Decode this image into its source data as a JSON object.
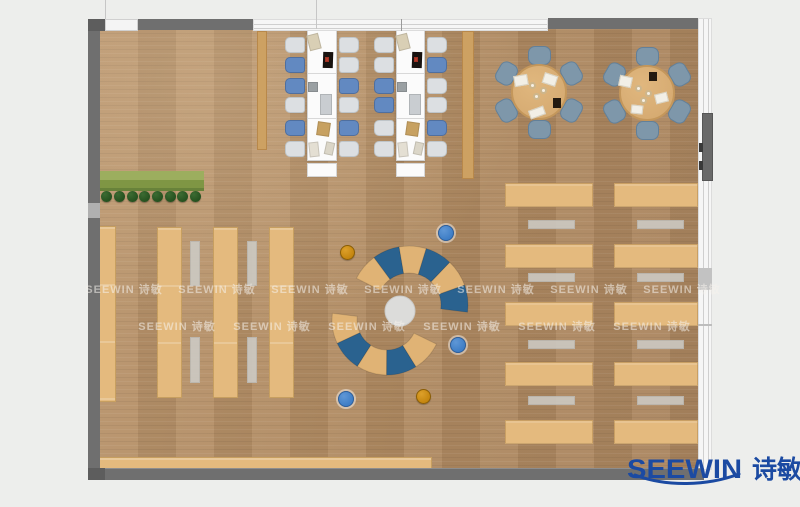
{
  "brand": {
    "logo_text": "SEEWIN",
    "logo_cn": "诗敏",
    "logo_color": "#1b4aa2"
  },
  "watermark": {
    "text": "SEEWIN 诗敏",
    "rows": [
      {
        "y": 281,
        "xs": [
          124,
          217,
          310,
          403,
          496,
          589,
          682
        ]
      },
      {
        "y": 318,
        "xs": [
          177,
          272,
          367,
          462,
          557,
          652
        ]
      }
    ]
  },
  "palette": {
    "bg": "#edeeec",
    "wood": "#b28e66",
    "wall": "#6f6f6f",
    "wall_dark": "#5d5d5d",
    "window": "#f6f6f6",
    "desk_white": "#fbfbfb",
    "chair_blue": "#6289c1",
    "chair_gray": "#dcdfe2",
    "table_tan": "#e4ba7e",
    "bench_gray": "#ccc9c2",
    "slate_chair": "#7e97aa",
    "sofa_blue": "#2a628f",
    "sofa_tan": "#e0b375",
    "lounge_circle": "#dcdcda",
    "green_bench": "#8ca050",
    "plant_green": "#25511f",
    "ottoman_blue": "#3f7ec6",
    "ottoman_orange": "#c5860f"
  },
  "furniture": {
    "green_bench": {
      "x": 100,
      "y": 171,
      "w": 104,
      "h": 20
    },
    "plants": {
      "y": 191,
      "size": 11,
      "xs": [
        106,
        119,
        132,
        144,
        157,
        170,
        182,
        195
      ]
    },
    "wood_strips": [
      {
        "x": 257,
        "y": 31,
        "w": 10,
        "h": 119
      },
      {
        "x": 462,
        "y": 31,
        "w": 12,
        "h": 148
      }
    ],
    "desk_clusters": [
      {
        "x": 307,
        "y": 30,
        "w": 30,
        "h": 131,
        "left_chairs": [
          "gray",
          "blue",
          "blue",
          "gray",
          "blue",
          "gray"
        ],
        "right_chairs": [
          "gray",
          "gray",
          "blue",
          "gray",
          "blue",
          "gray"
        ]
      },
      {
        "x": 396,
        "y": 30,
        "w": 29,
        "h": 131,
        "left_chairs": [
          "gray",
          "gray",
          "blue",
          "blue",
          "gray",
          "gray"
        ],
        "right_chairs": [
          "gray",
          "blue",
          "gray",
          "gray",
          "blue",
          "gray"
        ]
      }
    ],
    "desk_chair_rel_ys": [
      7,
      27,
      48,
      67,
      90,
      111
    ],
    "desk_props": [
      {
        "dx": 1,
        "dy": 4,
        "w": 12,
        "h": 16,
        "rot": -14,
        "c": "#d9cfb5"
      },
      {
        "dx": 16,
        "dy": 22,
        "w": 10,
        "h": 16,
        "rot": 2,
        "c": "#191310"
      },
      {
        "dx": 18,
        "dy": 27,
        "w": 4,
        "h": 5,
        "rot": 0,
        "c": "#b43a2a"
      },
      {
        "dx": 1,
        "dy": 52,
        "w": 10,
        "h": 10,
        "rot": 0,
        "c": "#9aa0a3"
      },
      {
        "dx": 13,
        "dy": 64,
        "w": 12,
        "h": 21,
        "rot": 0,
        "c": "#c9cdd1"
      },
      {
        "dx": 10,
        "dy": 92,
        "w": 13,
        "h": 14,
        "rot": 8,
        "c": "#c7a161"
      },
      {
        "dx": 2,
        "dy": 112,
        "w": 10,
        "h": 15,
        "rot": -6,
        "c": "#e4dfd3"
      },
      {
        "dx": 18,
        "dy": 112,
        "w": 9,
        "h": 13,
        "rot": 12,
        "c": "#dbd6c8"
      }
    ],
    "round_tables": [
      {
        "cx": 539,
        "cy": 92,
        "r": 28,
        "props": [
          {
            "dx": 4,
            "dy": -18,
            "w": 14,
            "h": 11,
            "rot": 18,
            "c": "paper"
          },
          {
            "dx": -25,
            "dy": -17,
            "w": 14,
            "h": 11,
            "rot": -10,
            "c": "paper"
          },
          {
            "dx": 14,
            "dy": 6,
            "w": 8,
            "h": 10,
            "rot": 0,
            "c": "dark"
          },
          {
            "dx": -10,
            "dy": 16,
            "w": 16,
            "h": 9,
            "rot": -20,
            "c": "paper"
          }
        ],
        "cups": [
          {
            "dx": -7,
            "dy": -7
          },
          {
            "dx": 4,
            "dy": -2
          },
          {
            "dx": -3,
            "dy": 4
          }
        ]
      },
      {
        "cx": 647,
        "cy": 93,
        "r": 28,
        "props": [
          {
            "dx": -28,
            "dy": -17,
            "w": 13,
            "h": 11,
            "rot": 12,
            "c": "paper"
          },
          {
            "dx": 2,
            "dy": -21,
            "w": 8,
            "h": 9,
            "rot": 0,
            "c": "dark"
          },
          {
            "dx": 8,
            "dy": 0,
            "w": 13,
            "h": 10,
            "rot": -14,
            "c": "paper"
          },
          {
            "dx": -16,
            "dy": 12,
            "w": 12,
            "h": 9,
            "rot": 6,
            "c": "paper"
          }
        ],
        "cups": [
          {
            "dx": -9,
            "dy": -5
          },
          {
            "dx": 1,
            "dy": 0
          },
          {
            "dx": -4,
            "dy": 7
          }
        ]
      }
    ],
    "round_chair_angles": [
      -90,
      -30,
      30,
      90,
      150,
      210
    ],
    "left_tables": [
      {
        "x": 98,
        "y": 226,
        "w": 18,
        "h": 176
      },
      {
        "x": 157,
        "y": 227,
        "w": 25,
        "h": 171
      },
      {
        "x": 213,
        "y": 227,
        "w": 25,
        "h": 171
      },
      {
        "x": 269,
        "y": 227,
        "w": 25,
        "h": 171
      }
    ],
    "left_benches": [
      {
        "x": 190,
        "y": 241,
        "w": 10,
        "h": 45
      },
      {
        "x": 190,
        "y": 337,
        "w": 10,
        "h": 46
      },
      {
        "x": 247,
        "y": 241,
        "w": 10,
        "h": 45
      },
      {
        "x": 247,
        "y": 337,
        "w": 10,
        "h": 46
      }
    ],
    "right_tables": {
      "cols": [
        505,
        614
      ],
      "widths": [
        88,
        84
      ],
      "rows": [
        183,
        244,
        302,
        362,
        420
      ],
      "h": 24
    },
    "right_benches": {
      "cols": [
        528,
        637
      ],
      "w": 47,
      "rows": [
        220,
        273,
        340,
        396
      ],
      "h": 9
    },
    "bottom_bench": {
      "x": 97,
      "y": 457,
      "w": 335,
      "h": 13
    },
    "lounge": {
      "center": {
        "cx": 400,
        "cy": 311,
        "r": 15
      },
      "groups": [
        {
          "cx": 409,
          "cy": 305,
          "rIn": 32,
          "rOut": 59,
          "a0": 207,
          "a1": 367,
          "colors": [
            "tan",
            "blue",
            "tan",
            "blue",
            "tan",
            "blue"
          ]
        },
        {
          "cx": 387,
          "cy": 320,
          "rIn": 30,
          "rOut": 55,
          "a0": 187,
          "a1": 26,
          "colors": [
            "tan",
            "blue",
            "tan",
            "blue",
            "tan"
          ]
        }
      ]
    },
    "ottomans": [
      {
        "x": 446,
        "y": 233,
        "r": 8,
        "c": "blue"
      },
      {
        "x": 347,
        "y": 252,
        "r": 7.5,
        "c": "orange"
      },
      {
        "x": 458,
        "y": 345,
        "r": 8,
        "c": "blue"
      },
      {
        "x": 346,
        "y": 399,
        "r": 8,
        "c": "blue"
      },
      {
        "x": 423,
        "y": 396,
        "r": 7.5,
        "c": "orange"
      }
    ]
  }
}
